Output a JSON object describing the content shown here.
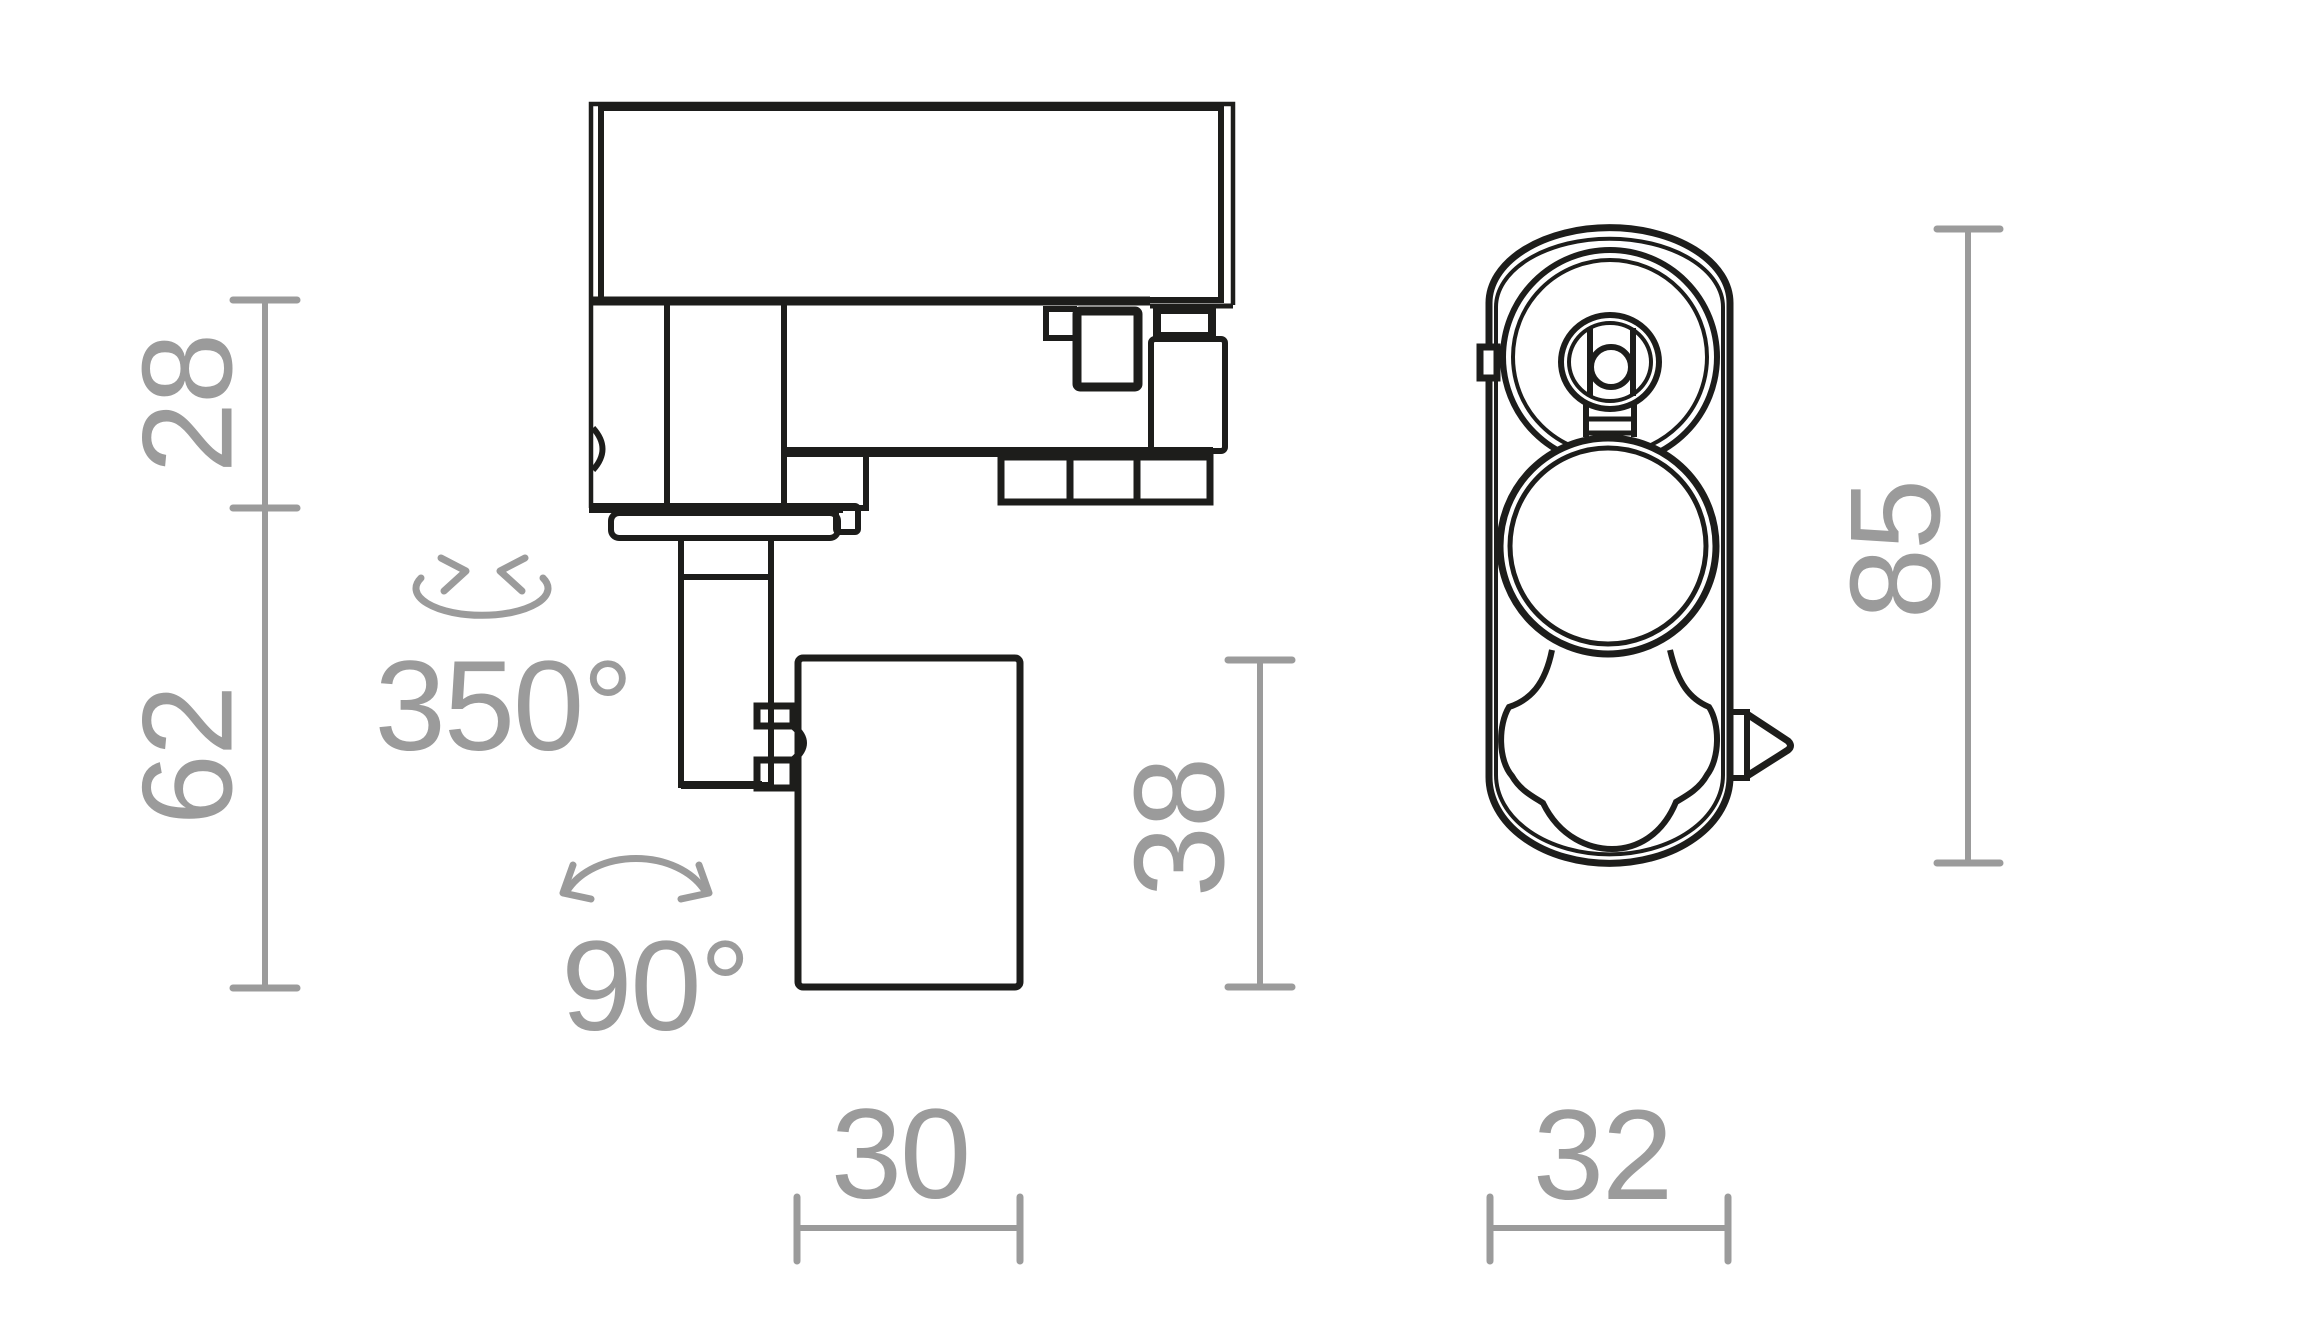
{
  "drawing": {
    "kind": "technical dimension drawing",
    "views": [
      "side view",
      "bottom view"
    ]
  },
  "colors": {
    "background": "#ffffff",
    "outline": "#1d1d1b",
    "dimension_gray": "#9b9b9b"
  },
  "side_view": {
    "dims": {
      "adapter_height": "28",
      "lower_height": "62",
      "head_height": "38",
      "head_width": "30"
    },
    "rotations": {
      "swivel_range": "350°",
      "tilt_range": "90°"
    }
  },
  "bottom_view": {
    "dims": {
      "body_length": "85",
      "body_width": "32"
    }
  }
}
